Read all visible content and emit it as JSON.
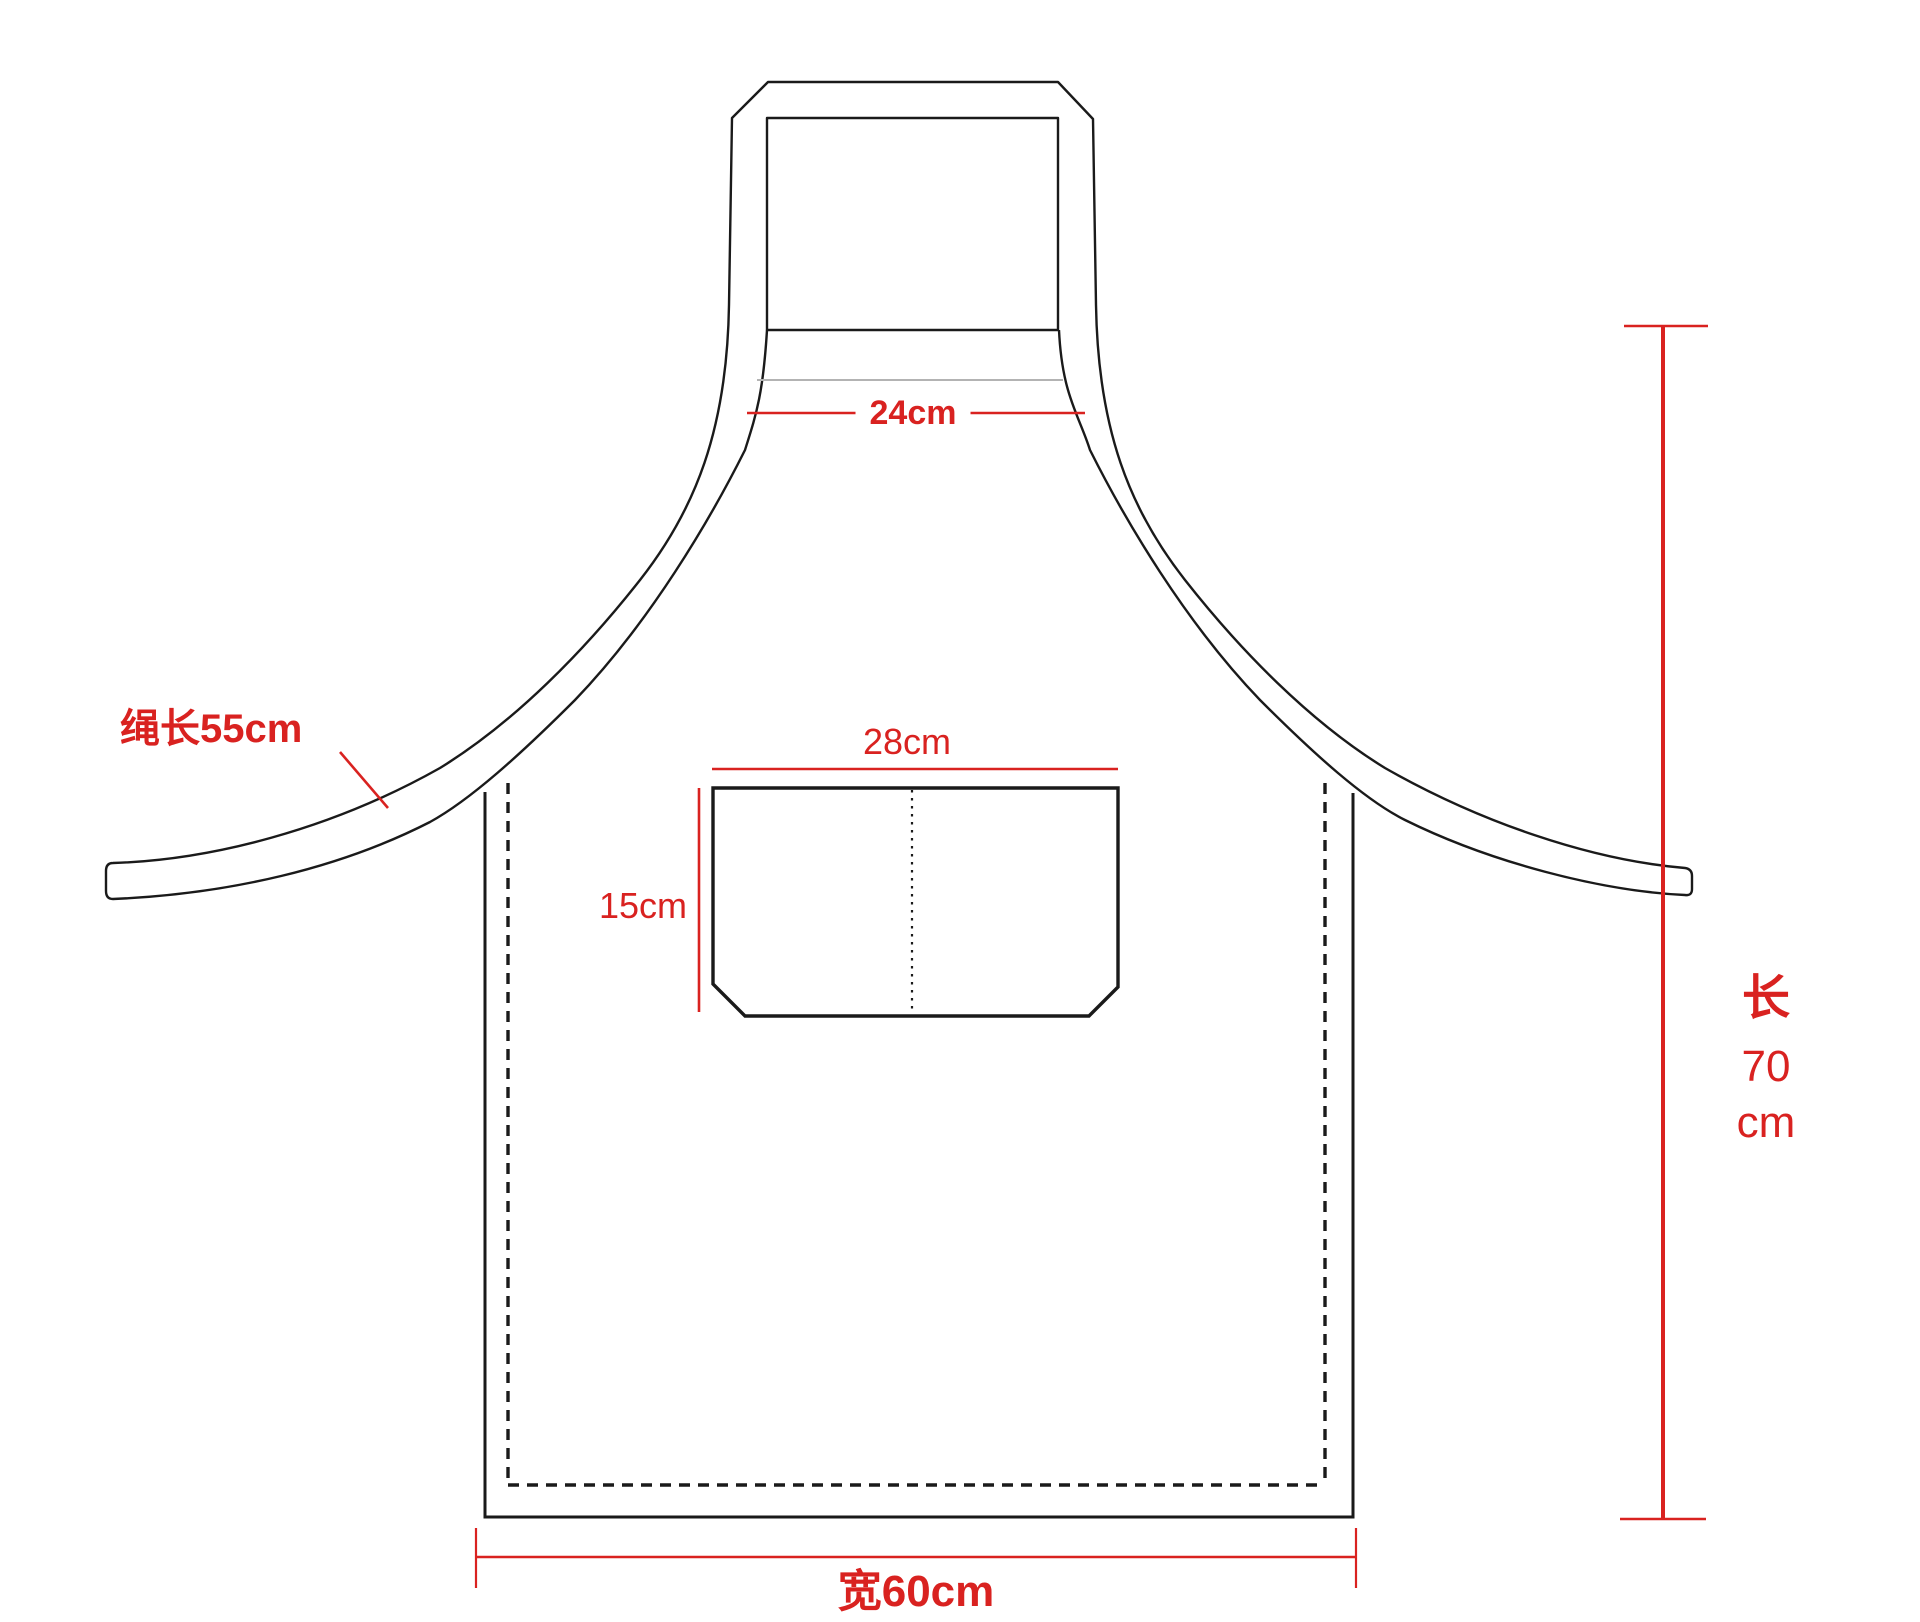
{
  "colors": {
    "red": "#d92220",
    "black": "#1a1a1a",
    "gray_seam": "#b3b3b3",
    "bg": "#ffffff"
  },
  "annotations": {
    "neck_width": {
      "label": "24cm"
    },
    "strap": {
      "label": "绳长55cm"
    },
    "pocket_width": {
      "label": "28cm"
    },
    "pocket_height": {
      "label": "15cm"
    },
    "length": {
      "char": "长",
      "value": "70",
      "unit": "cm"
    },
    "bottom_width": {
      "label": "宽60cm"
    }
  }
}
